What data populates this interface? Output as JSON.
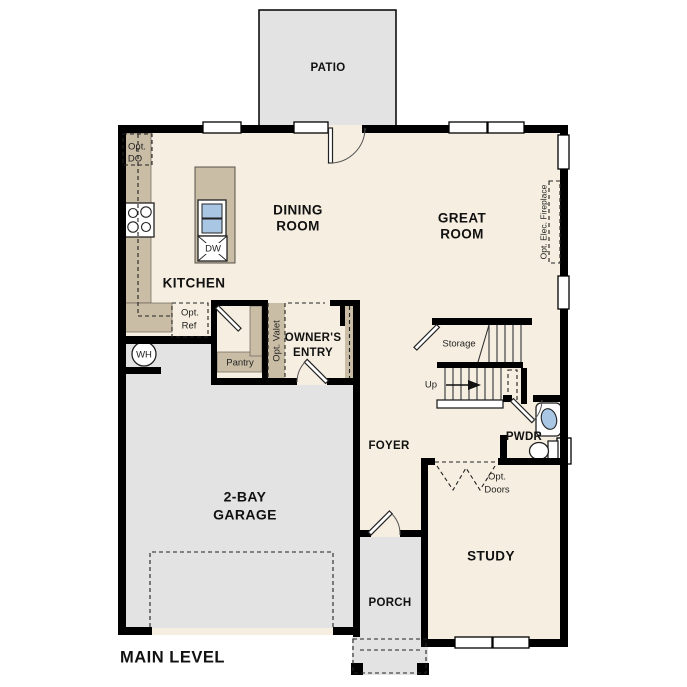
{
  "title": "MAIN LEVEL",
  "colors": {
    "floor": "#f6efe1",
    "concrete": "#e3e3e3",
    "cabinet": "#cabda5",
    "fixture": "#a9c7e5",
    "wall": "#000000"
  },
  "rooms": {
    "patio": "PATIO",
    "dining1": "DINING",
    "dining2": "ROOM",
    "great1": "GREAT",
    "great2": "ROOM",
    "kitchen": "KITCHEN",
    "owners1": "OWNER'S",
    "owners2": "ENTRY",
    "garage1": "2-BAY",
    "garage2": "GARAGE",
    "foyer": "FOYER",
    "pwdr": "PWDR",
    "study": "STUDY",
    "porch": "PORCH"
  },
  "features": {
    "storage": "Storage",
    "up": "Up",
    "pantry": "Pantry",
    "valet": "Opt. Valet",
    "ref1": "Opt.",
    "ref2": "Ref",
    "do1": "Opt.",
    "do2": "DO",
    "doors1": "Opt.",
    "doors2": "Doors",
    "fireplace": "Opt. Elec. Fireplace",
    "wh": "WH",
    "dw": "DW"
  }
}
